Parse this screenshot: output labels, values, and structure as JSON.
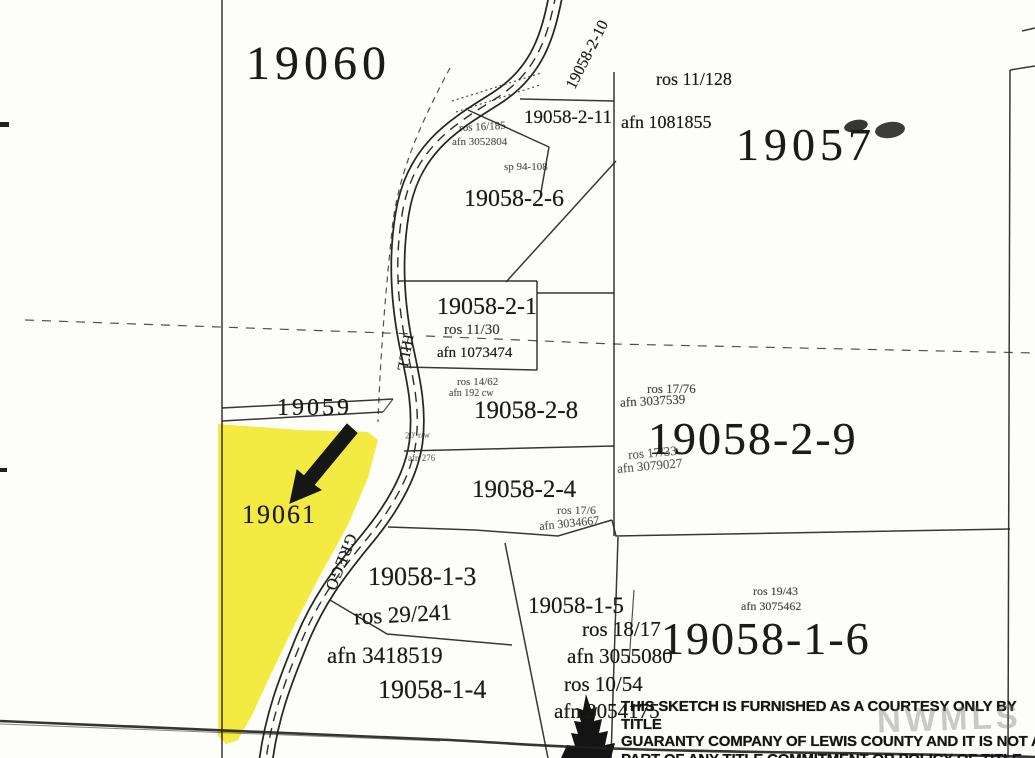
{
  "map": {
    "parcel_labels": {
      "p19060": "19060",
      "p19057": "19057",
      "p19058_2_10": "19058-2-10",
      "p19058_2_11": "19058-2-11",
      "p19058_2_6": "19058-2-6",
      "p19058_2_1": "19058-2-1",
      "p19058_2_8": "19058-2-8",
      "p19058_2_9": "19058-2-9",
      "p19058_2_4": "19058-2-4",
      "p19059": "19059",
      "p19061": "19061",
      "p19058_1_3": "19058-1-3",
      "p19058_1_4": "19058-1-4",
      "p19058_1_5": "19058-1-5",
      "p19058_1_6": "19058-1-6"
    },
    "road_names": {
      "hill": "HILL",
      "grego": "GREGO"
    },
    "survey_refs": {
      "ros_11_128": "ros 11/128",
      "afn_1081855": "afn 1081855",
      "ros_16_185": "ros 16/185",
      "afn_3052804": "afn 3052804",
      "sp_94_108": "sp 94-108",
      "ros_11_30": "ros 11/30",
      "afn_1073474": "afn 1073474",
      "ros_14_62": "ros 14/62",
      "afn_192": "afn 192 cw",
      "rw_note": "20' r/w",
      "afn_276": "afn 276",
      "ros_17_76": "ros 17/76",
      "afn_3037539": "afn 3037539",
      "ros_17_33": "ros 17/33",
      "afn_3079027": "afn 3079027",
      "ros_17_6": "ros 17/6",
      "afn_3034667": "afn 3034667",
      "ros_29_241": "ros 29/241",
      "afn_3418519": "afn 3418519",
      "ros_18_17": "ros 18/17",
      "afn_3055080": "afn 3055080",
      "ros_10_54": "ros 10/54",
      "afn_3054175": "afn 3054175",
      "ros_19_43": "ros 19/43",
      "afn_3075462": "afn 3075462"
    },
    "colors": {
      "highlight_yellow": "#F4EC33",
      "ink": "#1b1b1b"
    }
  },
  "disclaimer": {
    "line1": "THIS SKETCH IS FURNISHED AS A COURTESY ONLY BY TITLE",
    "line2": "GUARANTY COMPANY OF LEWIS COUNTY AND IT IS NOT A",
    "line3": "PART OF ANY TITLE COMMITMENT OR POLICY OF TITLE"
  },
  "watermark": "NWMLS"
}
